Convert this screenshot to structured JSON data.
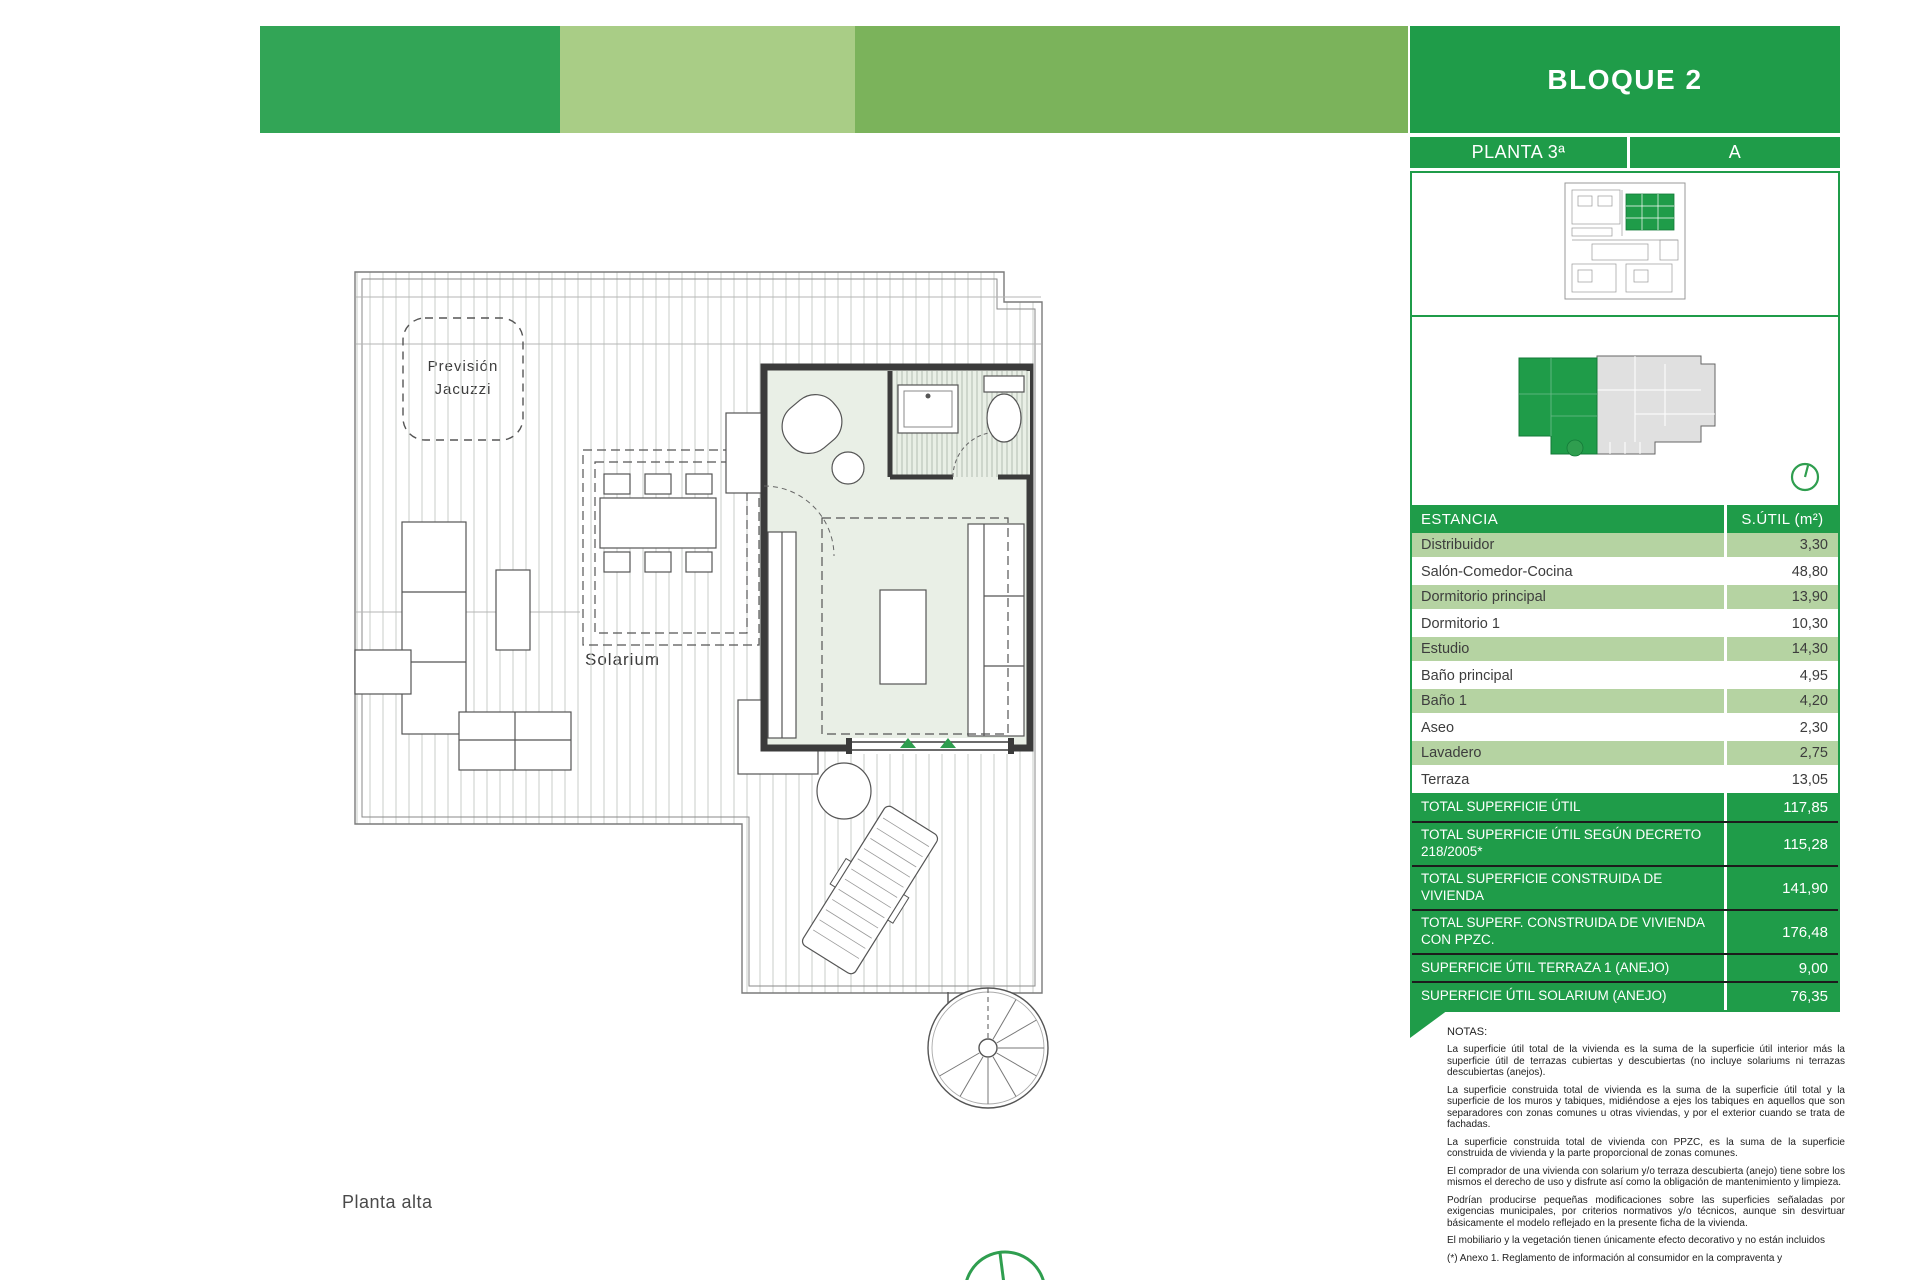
{
  "header": {
    "block_title": "BLOQUE 2",
    "floor_label": "PLANTA 3ª",
    "unit_label": "A"
  },
  "plan": {
    "labels": {
      "jacuzzi_line1": "Previsión",
      "jacuzzi_line2": "Jacuzzi",
      "aseo": "Aseo",
      "estudio": "Estudio",
      "solarium": "Solarium",
      "caption": "Planta alta"
    }
  },
  "table": {
    "header": {
      "room": "ESTANCIA",
      "area": "S.ÚTIL (m²)"
    },
    "rows": [
      {
        "label": "Distribuidor",
        "value": "3,30"
      },
      {
        "label": "Salón-Comedor-Cocina",
        "value": "48,80"
      },
      {
        "label": "Dormitorio principal",
        "value": "13,90"
      },
      {
        "label": "Dormitorio 1",
        "value": "10,30"
      },
      {
        "label": "Estudio",
        "value": "14,30"
      },
      {
        "label": "Baño principal",
        "value": "4,95"
      },
      {
        "label": "Baño 1",
        "value": "4,20"
      },
      {
        "label": "Aseo",
        "value": "2,30"
      },
      {
        "label": "Lavadero",
        "value": "2,75"
      },
      {
        "label": "Terraza",
        "value": "13,05"
      }
    ],
    "totals": [
      {
        "label": "TOTAL SUPERFICIE ÚTIL",
        "value": "117,85"
      },
      {
        "label": "TOTAL SUPERFICIE ÚTIL SEGÚN DECRETO 218/2005*",
        "value": "115,28"
      },
      {
        "label": "TOTAL SUPERFICIE CONSTRUIDA DE VIVIENDA",
        "value": "141,90"
      },
      {
        "label": "TOTAL SUPERF. CONSTRUIDA DE VIVIENDA CON PPZC.",
        "value": "176,48"
      },
      {
        "label": "SUPERFICIE ÚTIL TERRAZA 1 (ANEJO)",
        "value": "9,00"
      },
      {
        "label": "SUPERFICIE ÚTIL SOLARIUM (ANEJO)",
        "value": "76,35"
      }
    ]
  },
  "notes": {
    "title": "NOTAS:",
    "paragraphs": [
      "La superficie útil total de la vivienda es la suma de la superficie útil interior más la superficie útil de terrazas cubiertas y descubiertas (no incluye solariums ni terrazas descubiertas (anejos).",
      "La superficie construida total de vivienda es la suma de la superficie útil total y la superficie de los muros y tabiques, midiéndose a ejes los tabiques en aquellos que son separadores con zonas comunes u otras viviendas, y por el exterior cuando se trata de fachadas.",
      "La superficie construida total de vivienda con PPZC, es la suma de la superficie construida de vivienda y la parte proporcional de zonas comunes.",
      "El comprador de una vivienda con solarium y/o terraza descubierta (anejo) tiene sobre los mismos el derecho de uso y disfrute así como la obligación de mantenimiento y limpieza.",
      "Podrían producirse pequeñas modificaciones sobre las superficies señaladas por exigencias municipales, por criterios normativos y/o técnicos, aunque sin desvirtuar básicamente el modelo reflejado en la presente ficha de la vivienda.",
      "El mobiliario y la vegetación tienen únicamente efecto decorativo y no están incluidos",
      "(*) Anexo 1. Reglamento de información al consumidor en la compraventa y"
    ]
  },
  "colors": {
    "accent_green": "#1f9c49",
    "band1": "#32a556",
    "band2": "#a9cd86",
    "band3": "#7bb35b",
    "row_green": "#b5d3a2",
    "studio_fill": "#e9efe6"
  }
}
